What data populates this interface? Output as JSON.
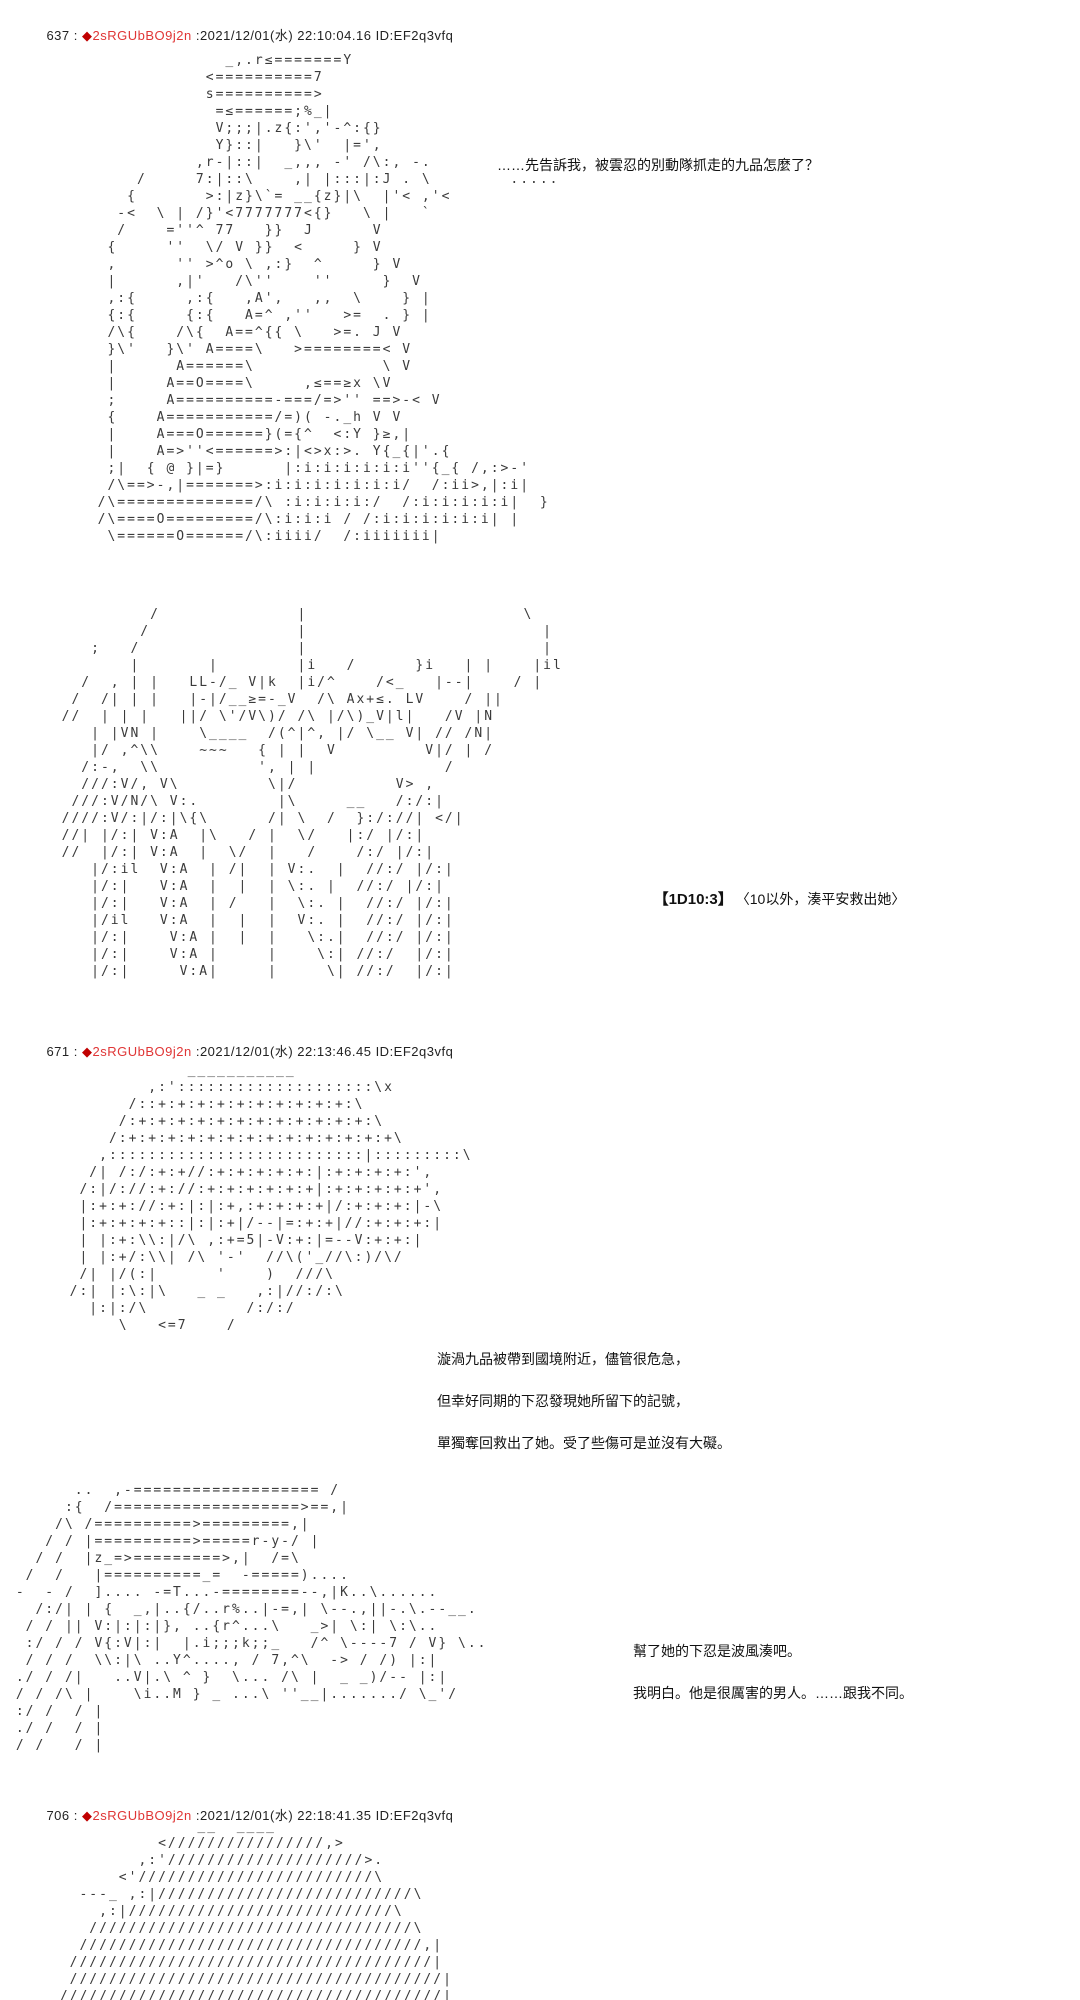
{
  "page": {
    "background": "#ffffff"
  },
  "colors": {
    "trip_diamond": "#c00000",
    "trip_name": "#e03636",
    "body_text": "#1a1a1a"
  },
  "posts": [
    {
      "number": "637",
      "separator": " : ",
      "trip_diamond": "◆",
      "trip_name": "2sRGUbBO9j2n",
      "meta": " :2021/12/01(水) 22:10:04.16 ID:EF2q3vfq",
      "dialogue": "……先告訴我，被雲忍的別動隊抓走的九品怎麼了？",
      "dice_label": "【1D10:3】",
      "dice_result": "〈10以外，湊平安救出她〉",
      "aa_top": [
        "               _,.r≤=======Y",
        "             <==========7",
        "             s==========>",
        "              =≤======;%_|",
        "              V;;;|.z{:','-^:{}",
        "              Y}::|   }\\'  |=',",
        "            ,r-|::|  _,,, -' /\\:, -.",
        "      /     7:|::\\    ,| |:::|:J . \\        .....",
        "     {       >:|z}\\`= __{z}|\\  |'< ,'<",
        "    -<  \\ | /}'<7777777<{}   \\ |   `",
        "    /    =''^ 77   }}  J      V",
        "   {     ''  \\/ V }}  <     } V",
        "   ,      '' >^o \\ ,:}  ^     } V",
        "   |      ,|'   /\\''    ''     }  V",
        "   ,:{     ,:{   ,A',   ,,  \\    } |",
        "   {:{     {:{   A=^ ,''   >=  . } |",
        "   /\\{    /\\{  A==^{{ \\   >=. J V",
        "   }\\'   }\\' A====\\   >========< V",
        "   |      A======\\             \\ V",
        "   |     A==O====\\     ,≤==≥x \\V",
        "   ;     A==========-===/=>'' ==>-< V",
        "   {    A===========/=)( -._h V V",
        "   |    A===O======}(={^  <:Y }≥,|",
        "   |    A=>''<======>:|<>x:>. Y{_{|'.{",
        "   ;|  { @ }|=}      |:i:i:i:i:i:i''{_{ /,:>-'",
        "   /\\==>-,|=======>:i:i:i:i:i:i:i/  /:ii>,|:i|",
        "  /\\==============/\\ :i:i:i:i:/  /:i:i:i:i:i|  }",
        "  /\\====O=========/\\:i:i:i / /:i:i:i:i:i:i| |",
        "   \\======O======/\\:iiii/  /:iiiiiii|"
      ],
      "aa_bottom": [
        "           /              |                      \\",
        "          /               |                        |",
        "     ;   /                |                        |",
        "         |       |        |i   /      }i   | |    |il",
        "    /  , | |   LL-/_ V|k  |i/^    /<_   |--|    / |",
        "   /  /| | |   |-|/__≥=-_V  /\\ Ax+≤. LV    / ||",
        "  //  | | |   ||/ \\'/V\\)/ /\\ |/\\)_V|l|   /V |N",
        "     | |VN |    \\____  /(^|^, |/ \\__ V| // /N|",
        "     |/ ,^\\\\    ~~~   { | |  V         V|/ | /",
        "    /:-,  \\\\          ', | |             /",
        "    ///:V/, V\\         \\|/          V> ,",
        "   ///:V/N/\\ V:.        |\\     __   /:/:|",
        "  ////:V/:|/:|\\{\\      /| \\  /  }:/://| </|",
        "  //| |/:| V:A  |\\   / |  \\/   |:/ |/:|",
        "  //  |/:| V:A  |  \\/  |   /    /:/ |/:|",
        "     |/:il  V:A  | /|  | V:.  |  //:/ |/:|",
        "     |/:|   V:A  |  |  | \\:. |  //:/ |/:|",
        "     |/:|   V:A  | /   |  \\:. |  //:/ |/:|",
        "     |/il   V:A  |  |  |  V:. |  //:/ |/:|",
        "     |/:|    V:A |  |  |   \\:.|  //:/ |/:|",
        "     |/:|    V:A |     |    \\:| //:/  |/:|",
        "     |/:|     V:A|     |     \\| //:/  |/:|"
      ]
    },
    {
      "number": "671",
      "separator": " : ",
      "trip_diamond": "◆",
      "trip_name": "2sRGUbBO9j2n",
      "meta": " :2021/12/01(水) 22:13:46.45 ID:EF2q3vfq",
      "narration": [
        "漩渦九品被帶到國境附近，儘管很危急，",
        "但幸好同期的下忍發現她所留下的記號，",
        "單獨奪回救出了她。受了些傷可是並沒有大礙。"
      ],
      "dialogue": [
        "幫了她的下忍是波風湊吧。",
        "我明白。他是很厲害的男人。……跟我不同。"
      ],
      "aa_top": [
        "              ___________",
        "          ,:'::::::::::::::::::::\\x",
        "        /::+:+:+:+:+:+:+:+:+:+:\\",
        "       /:+:+:+:+:+:+:+:+:+:+:+:+:\\",
        "      /:+:+:+:+:+:+:+:+:+:+:+:+:+:+\\",
        "     ,::::::::::::::::::::::::::|:::::::::\\",
        "    /| /:/:+:+//:+:+:+:+:+:|:+:+:+:+:',",
        "   /:|/://:+://:+:+:+:+:+:+|:+:+:+:+:+',",
        "   |:+:+://:+:|:|:+,:+:+:+:+|/:+:+:+:|-\\",
        "   |:+:+:+:+::|:|:+|/--|=:+:+|//:+:+:+:|",
        "   | |:+:\\\\:|/\\ ,:+=5|-V:+:|=--V:+:+:|",
        "   | |:+/:\\\\| /\\ '-'  //\\('_//\\:)/\\/",
        "   /| |/(:|      '    )  ///\\",
        "  /:| |:\\:|\\   _ _   ,:|//:/:\\",
        "    |:|:/\\          /:/:/",
        "       \\   <=7    /"
      ],
      "aa_bottom": [
        "       ..  ,-=================== /",
        "      :{  /===================>==,|",
        "     /\\ /==========>=========,|",
        "    / / |==========>=====r-y-/ |",
        "   / /  |z_=>=========>,|  /=\\",
        "  /  /   |==========_=  -=====)....",
        " -  - /  ].... -=T...-========--,|K..\\......",
        "   /:/| | {  _,|..{/..r%..|-=,| \\--.,||-.\\.--__.",
        "  / / || V:|:|:|}, ..{r^...\\   _>| \\:| \\:\\..",
        "  :/ / / V{:V|:|  |.i;;;k;;_   /^ \\----7 / V} \\..",
        "  / / /  \\\\:|\\ ..Y^...., / 7,^\\  -> / /) |:|",
        " ./ / /|   ..V|.\\ ^ }  \\... /\\ |  _ _)/-- |:|",
        " / / /\\ |    \\i..M } _ ...\\ ''__|......./ \\_'/",
        " :/ /  / |",
        " ./ /  / |",
        " / /   / |"
      ]
    },
    {
      "number": "706",
      "separator": " : ",
      "trip_diamond": "◆",
      "trip_name": "2sRGUbBO9j2n",
      "meta": " :2021/12/01(水) 22:18:41.35 ID:EF2q3vfq",
      "aa_top": [
        "               __  ____",
        "           <////////////////,>",
        "         ,:'////////////////////>.",
        "       <'////////////////////////\\",
        "   ---_ ,:|//////////////////////////\\",
        "     ,:|///////////////////////////\\",
        "    /////////////////////////////////\\",
        "   ///////////////////////////////////,|",
        "  /////////////////////////////////////|",
        "  //////////////////////////////////////|",
        " ///////////////////////////////////////|"
      ]
    }
  ]
}
